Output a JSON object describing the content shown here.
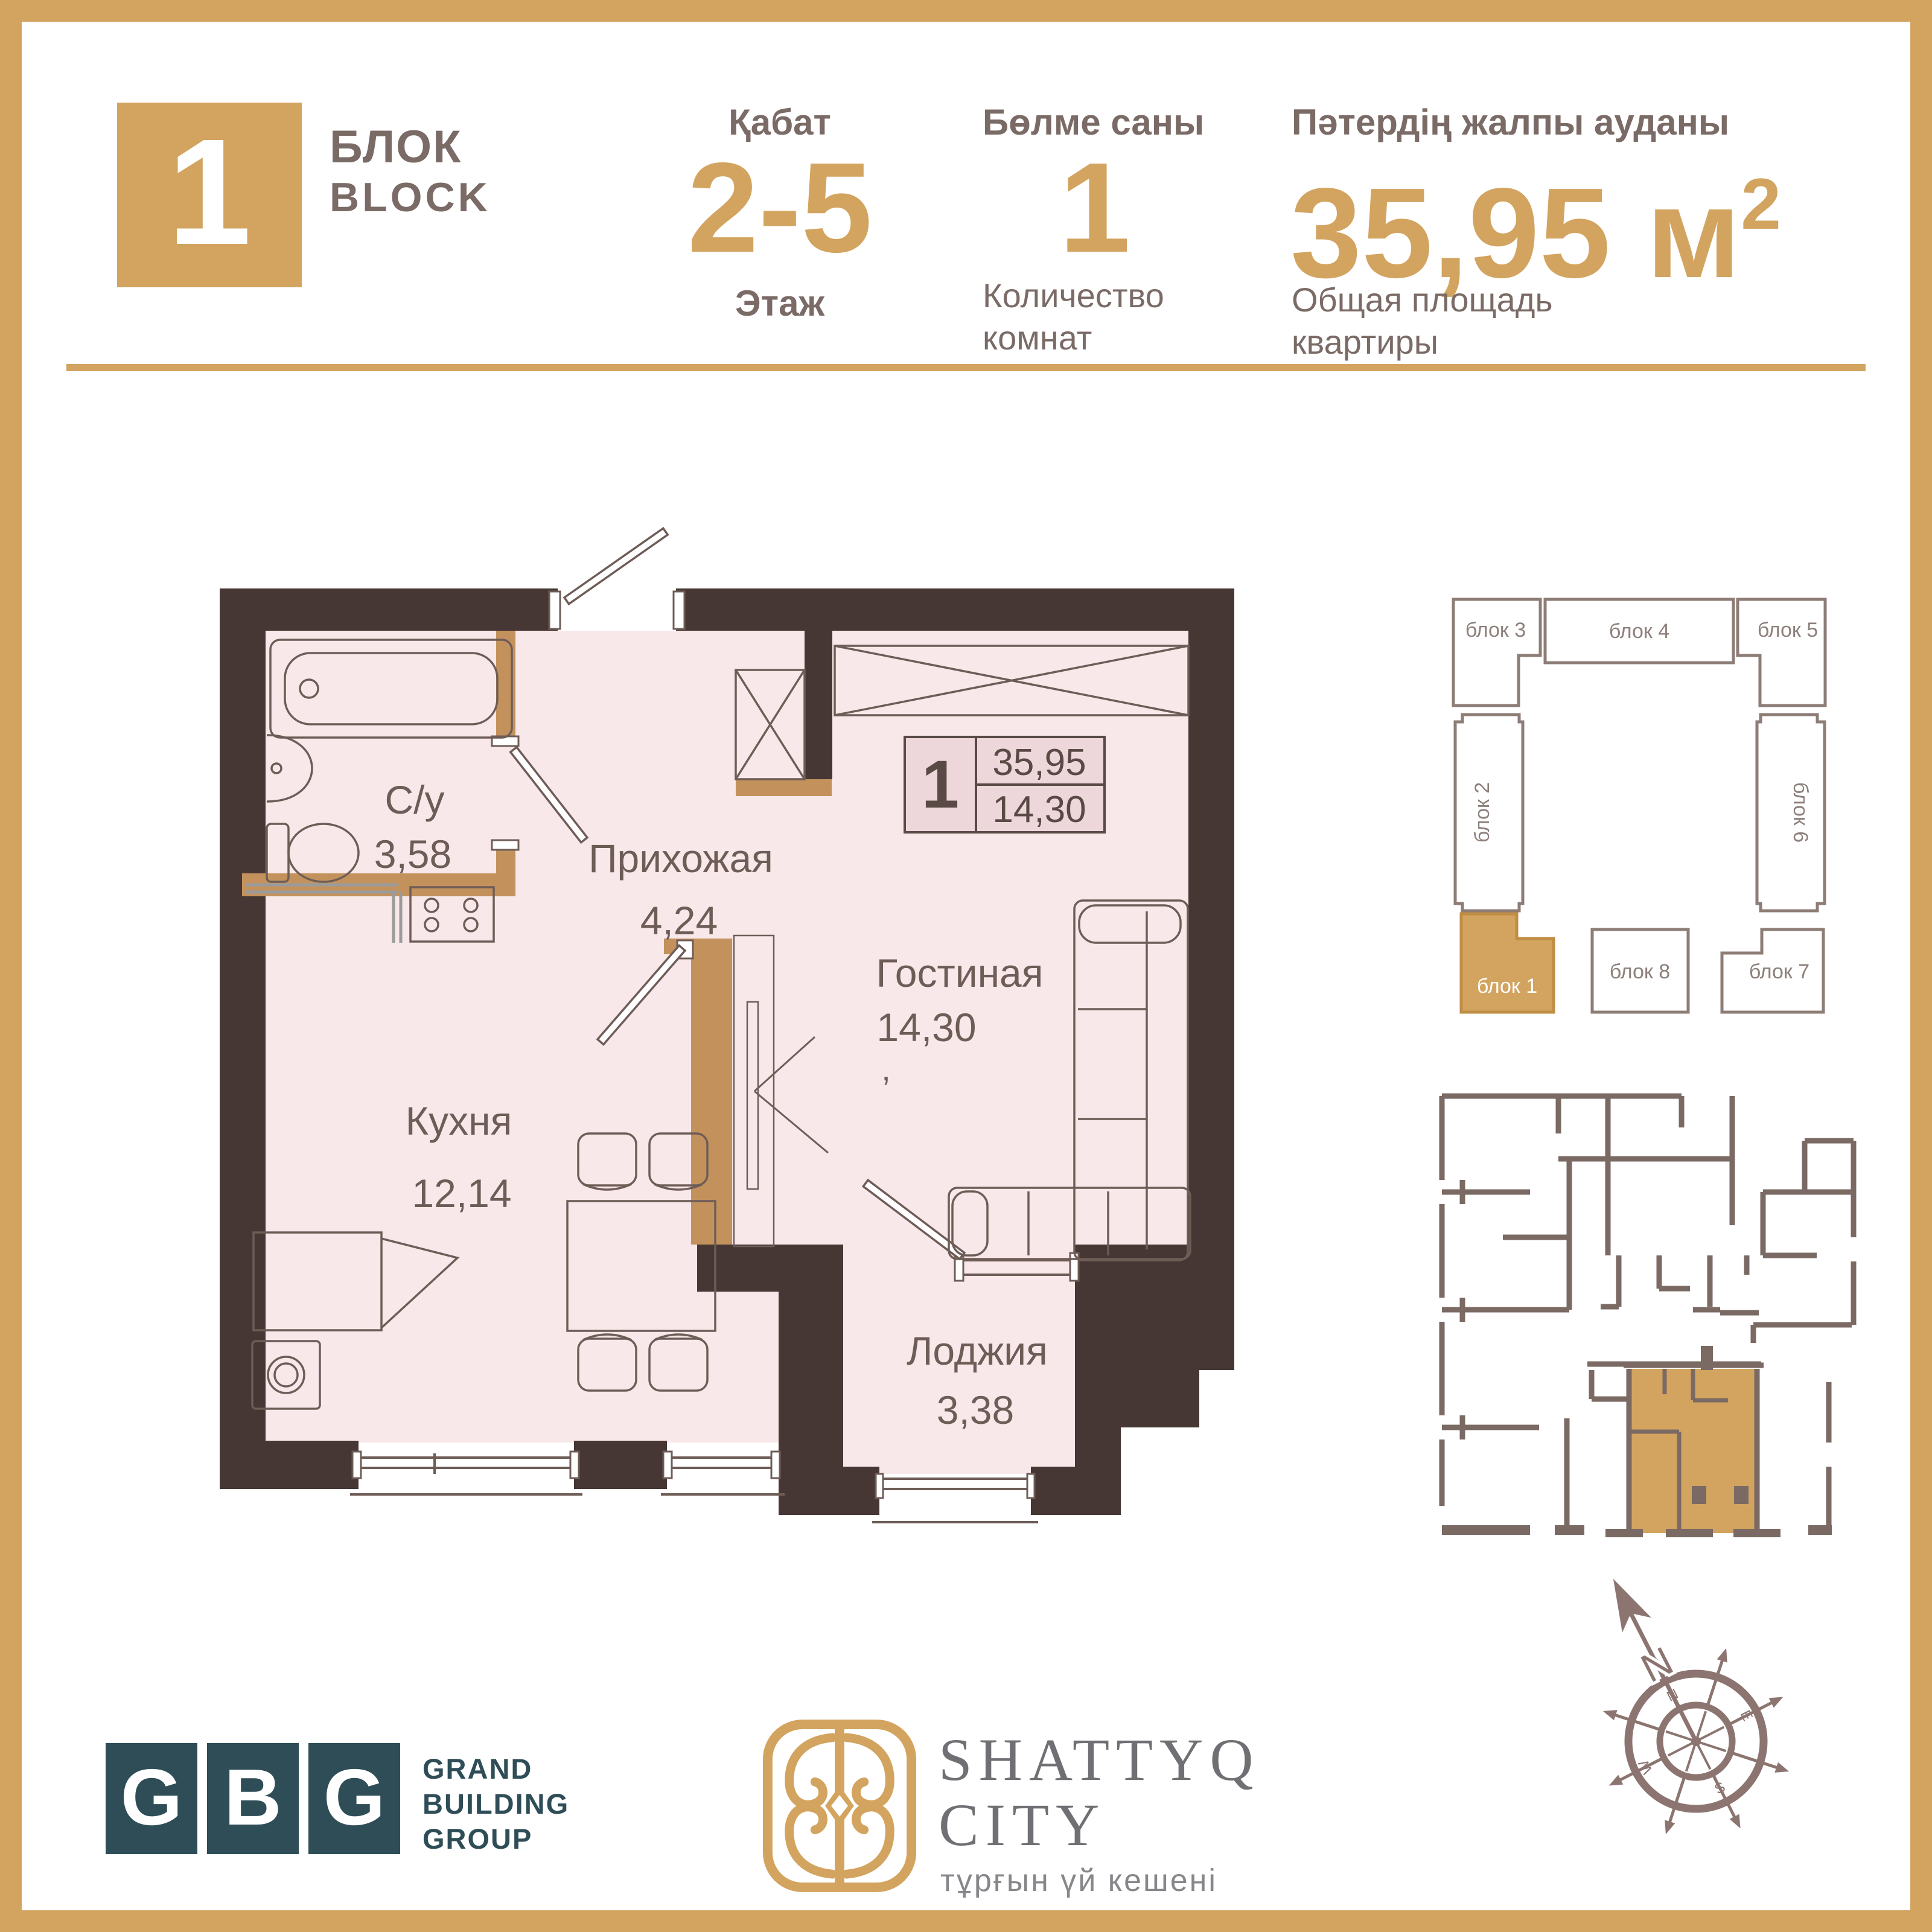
{
  "header": {
    "block_number": "1",
    "block_word_kk": "БЛОК",
    "block_word_en": "BLOCK",
    "floor_label_kk": "Қабат",
    "floor_value": "2-5",
    "floor_label_ru": "Этаж",
    "rooms_label_kk": "Бөлме саны",
    "rooms_value": "1",
    "rooms_label_ru_line1": "Количество",
    "rooms_label_ru_line2": "комнат",
    "area_label_kk": "Пәтердің жалпы ауданы",
    "area_value": "35,95",
    "area_unit": "м",
    "area_sup": "2",
    "area_label_ru_line1": "Общая площадь",
    "area_label_ru_line2": "квартиры"
  },
  "plan": {
    "rooms": [
      {
        "name": "С/у",
        "area": "3,58"
      },
      {
        "name": "Прихожая",
        "area": "4,24"
      },
      {
        "name": "Гостиная",
        "area": "14,30"
      },
      {
        "name": "Кухня",
        "area": "12,14"
      },
      {
        "name": "Лоджия",
        "area": "3,38"
      }
    ],
    "stray_comma": ",",
    "info_box": {
      "rooms": "1",
      "total_area": "35,95",
      "living_area": "14,30"
    }
  },
  "block_diagram": {
    "blocks": [
      "блок 1",
      "блок 2",
      "блок 3",
      "блок 4",
      "блок 5",
      "блок 6",
      "блок 7",
      "блок 8"
    ],
    "highlighted": "блок 1",
    "highlight_color": "#d2a45f"
  },
  "compass": {
    "north": "N",
    "cardinal": [
      "N",
      "E",
      "S",
      "W"
    ]
  },
  "footer": {
    "gbg": {
      "letters": [
        "G",
        "B",
        "G"
      ],
      "name_line1": "GRAND",
      "name_line2": "BUILDING",
      "name_line3": "GROUP"
    },
    "shattyq": {
      "title_line1": "SHATTYQ",
      "title_line2": "CITY",
      "tagline": "тұрғын үй кешені"
    }
  },
  "colors": {
    "gold": "#d2a45f",
    "partition_gold": "#c3925c",
    "wall": "#463734",
    "floor": "#f8e8e9",
    "info_box_bg": "#eed7da",
    "plan_line": "#6e5c57",
    "header_text": "#7b6b66",
    "mini_wall": "#7b6a64",
    "diagram_stroke": "#8d7d76",
    "gbg_teal": "#2e4d57",
    "compass": "#8c7570"
  }
}
